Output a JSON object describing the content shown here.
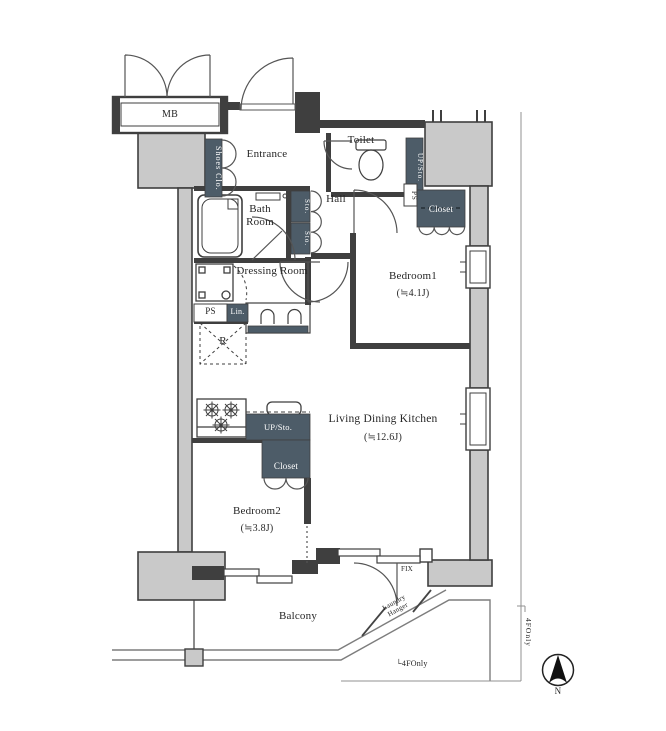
{
  "labels": {
    "mb": "MB",
    "shoes_closet": "Shoes Clo.",
    "entrance": "Entrance",
    "toilet": "Toilet",
    "up_sto_top": "UP/Sto.",
    "ps_top": "PS",
    "closet_bedroom1": "Closet",
    "bath_room": "Bath Room",
    "sto_upper": "Sto.",
    "sto_lower": "Sto.",
    "hall": "Hall",
    "dressing_room": "Dressing Room",
    "ps_left": "PS",
    "linen": "Lin.",
    "refrigerator": "R",
    "bedroom1": "Bedroom1",
    "bedroom1_size": "(≒4.1J)",
    "ldk": "Living Dining Kitchen",
    "ldk_size": "(≒12.6J)",
    "up_sto_kitchen": "UP/Sto.",
    "closet_bedroom2": "Closet",
    "bedroom2": "Bedroom2",
    "bedroom2_size": "(≒3.8J)",
    "balcony": "Balcony",
    "fix": "FIX",
    "laundry_line1": "Laundry",
    "laundry_line2": "Hanger",
    "note_bottom": "└4FOnly",
    "note_right": "4FOnly",
    "north": "N"
  },
  "colors": {
    "wall": "#3f3f3f",
    "concrete_fill": "#c9c9c9",
    "storage_dark": "#4d5c68",
    "door_line": "#555555",
    "boundary_line": "#909090",
    "background": "#ffffff"
  }
}
